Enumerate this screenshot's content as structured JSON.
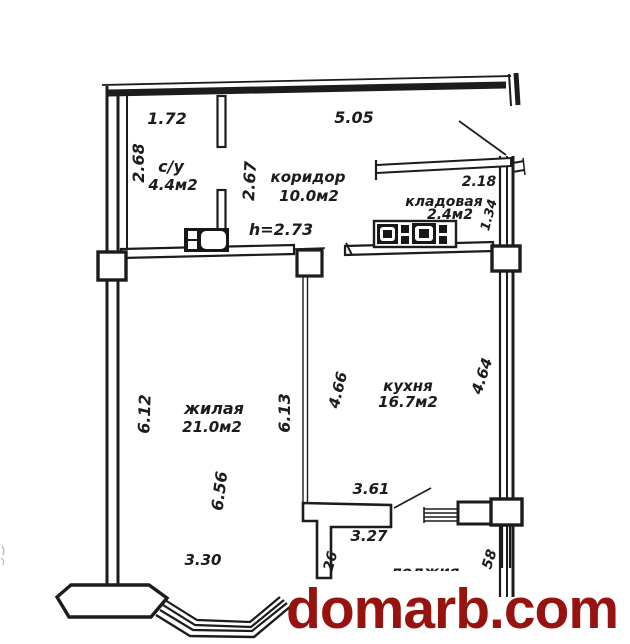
{
  "page": {
    "background": "#ffffff",
    "ink_color": "#1c1c1c"
  },
  "watermark": {
    "text": "domarb.com",
    "color": "#971310"
  },
  "plan": {
    "ceiling_height_label": "h=2.73",
    "rooms": {
      "bathroom": {
        "name": "с/у",
        "area": "4.4м2"
      },
      "corridor": {
        "name": "коридор",
        "area": "10.0м2"
      },
      "storage": {
        "name": "кладовая",
        "area": "2.4м2"
      },
      "living": {
        "name": "жилая",
        "area": "21.0м2"
      },
      "kitchen": {
        "name": "кухня",
        "area": "16.7м2"
      },
      "loggia": {
        "name": "лоджия"
      }
    },
    "dimensions": {
      "bathroom_top": "1.72",
      "corridor_top": "5.05",
      "bathroom_left": "2.68",
      "corridor_partition": "2.67",
      "storage_top": "2.18",
      "storage_right": "1.34",
      "living_left": "6.12",
      "living_right": "6.13",
      "kitchen_left": "4.66",
      "kitchen_right": "4.64",
      "living_inner_height": "6.56",
      "living_bay_width": "3.30",
      "loggia_top": "3.61",
      "loggia_width": "3.27",
      "loggia_left_partial": "26",
      "loggia_right_partial": "58"
    }
  }
}
